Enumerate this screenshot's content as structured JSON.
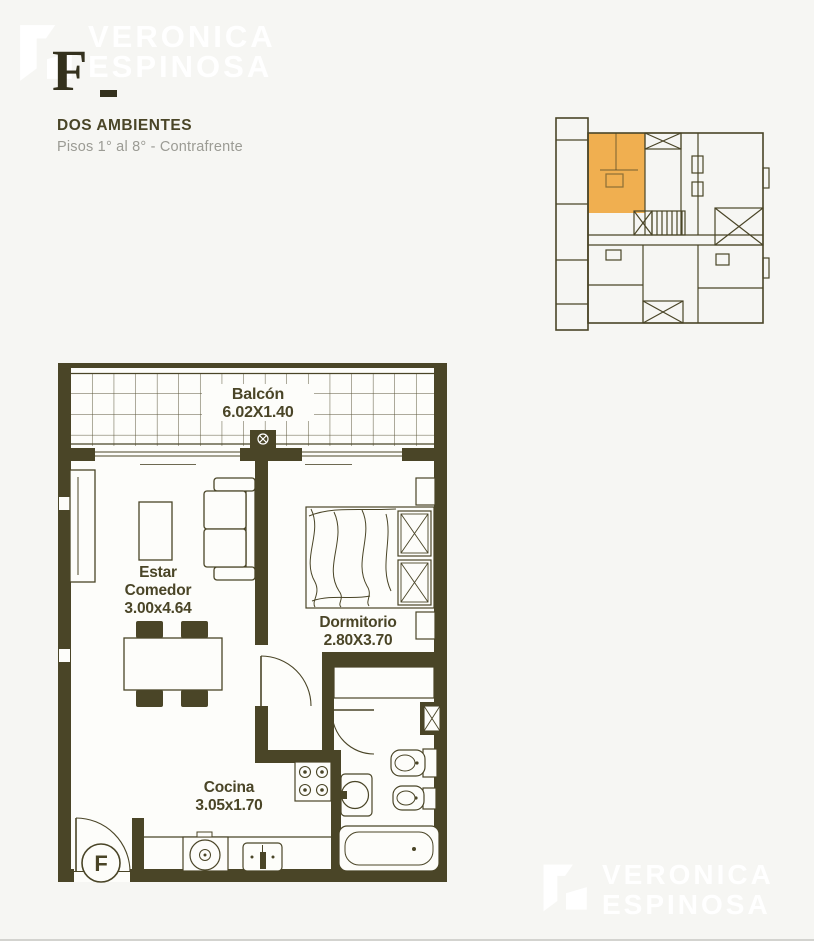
{
  "brand": {
    "line1": "VERONICA",
    "line2": "ESPINOSA"
  },
  "header": {
    "unit_letter": "F",
    "title": "DOS AMBIENTES",
    "subtitle": "Pisos 1° al 8° - Contrafrente"
  },
  "key_plan": {
    "highlight_color": "#f0a73e"
  },
  "floor_plan": {
    "entrance_label": "F",
    "balcony": {
      "label": "Balcón",
      "dims": "6.02X1.40"
    },
    "living": {
      "line1": "Estar",
      "line2": "Comedor",
      "dims": "3.00x4.64"
    },
    "bedroom": {
      "label": "Dormitorio",
      "dims": "2.80X3.70"
    },
    "kitchen": {
      "label": "Cocina",
      "dims": "3.05x1.70"
    }
  },
  "colors": {
    "wall": "#4a4527",
    "accent_orange": "#f0a73e",
    "subtitle_gray": "#9b9b94",
    "background": "#f6f6f3",
    "paper": "#fdfdfa"
  }
}
